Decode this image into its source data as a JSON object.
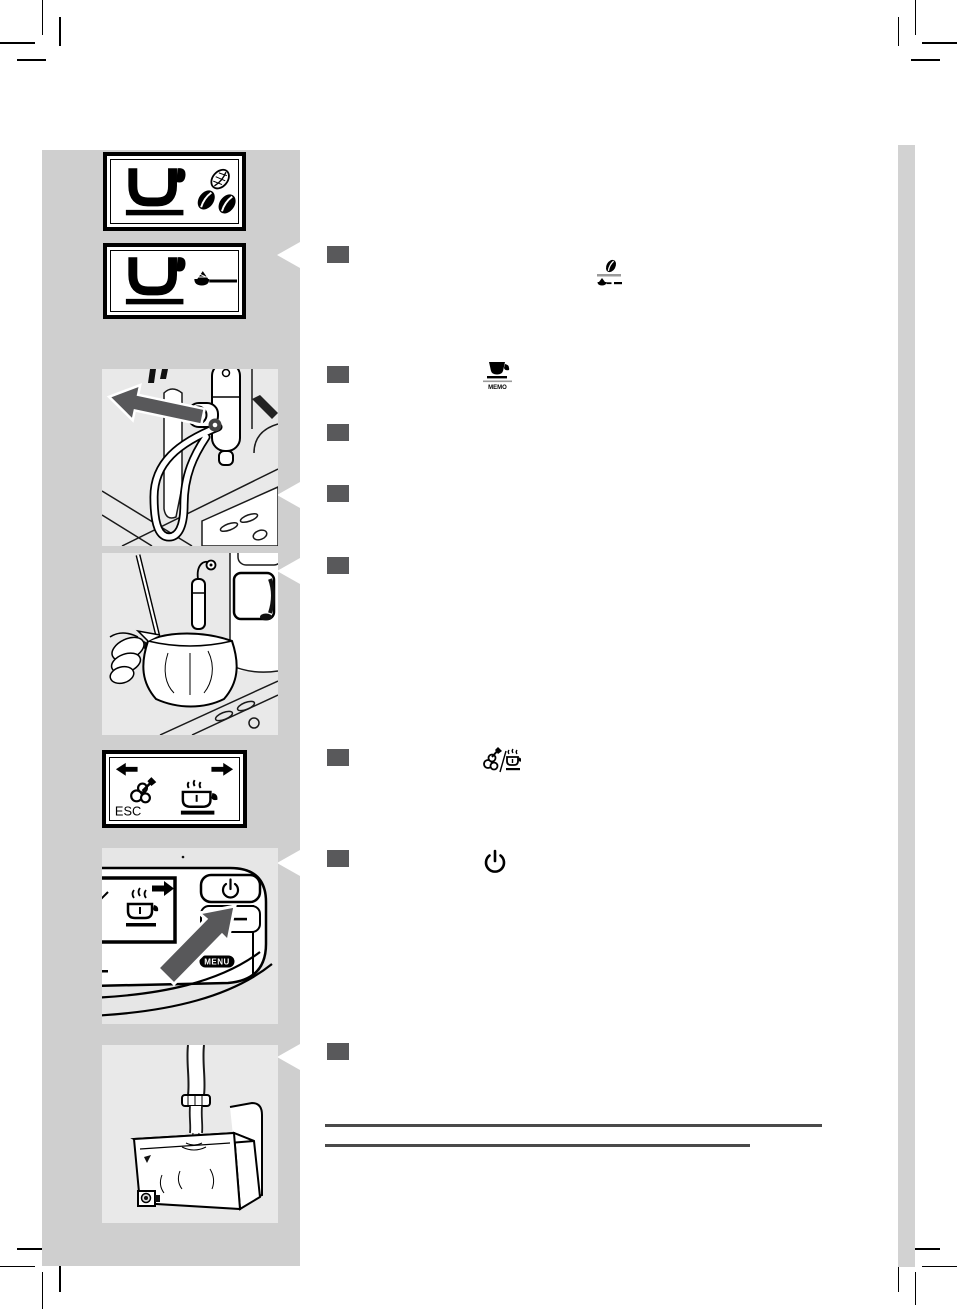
{
  "document": {
    "type": "coffee-machine-user-manual-page",
    "page_background": "#ffffff",
    "sidebar_background": "#cfcfcf",
    "illustration_background": "#e9e9e9",
    "control_panel_background": "#e6e6e6",
    "edge_tab_background": "#d2d2d2",
    "step_marker_color": "#59595b",
    "footer_rule_color": "#4a4a4a"
  },
  "sidebar": {
    "panels": [
      {
        "id": "display-espresso-beans",
        "kind": "lcd-display",
        "icons": [
          "espresso-cup-icon",
          "coffee-beans-icon"
        ]
      },
      {
        "id": "display-espresso-preground",
        "kind": "lcd-display",
        "icons": [
          "espresso-cup-icon",
          "ground-coffee-scoop-icon"
        ]
      },
      {
        "id": "illustration-remove-milk-frother",
        "kind": "line-art",
        "icons": [
          "direction-arrow-left-icon"
        ]
      },
      {
        "id": "illustration-frother-into-jug",
        "kind": "line-art",
        "icons": []
      },
      {
        "id": "display-special-menu",
        "kind": "lcd-display",
        "esc_label": "ESC",
        "icons": [
          "arrow-left-icon",
          "arrow-right-icon",
          "clean-cycle-icon",
          "hot-milk-cup-icon"
        ]
      },
      {
        "id": "illustration-press-standby",
        "kind": "line-art",
        "menu_label": "MENU",
        "icons": [
          "standby-icon",
          "press-arrow-icon",
          "hot-milk-cup-icon",
          "arrow-right-icon"
        ]
      },
      {
        "id": "illustration-fill-water-tank",
        "kind": "line-art",
        "icons": []
      }
    ]
  },
  "steps": [
    {
      "n": 1,
      "inline_icon": "preground-coffee-select-icon"
    },
    {
      "n": 2,
      "inline_icon": "espresso-memo-button-icon",
      "memo_label": "MEMO"
    },
    {
      "n": 3,
      "inline_icon": ""
    },
    {
      "n": 4,
      "inline_icon": ""
    },
    {
      "n": 5,
      "inline_icon": ""
    },
    {
      "n": 6,
      "inline_icon": "clean-or-hot-milk-icon"
    },
    {
      "n": 7,
      "inline_icon": "standby-button-icon"
    },
    {
      "n": 8,
      "inline_icon": ""
    }
  ],
  "footer": {
    "rules": [
      {
        "x": 325,
        "y": 1124,
        "width": 497
      },
      {
        "x": 325,
        "y": 1144,
        "width": 425
      }
    ]
  }
}
